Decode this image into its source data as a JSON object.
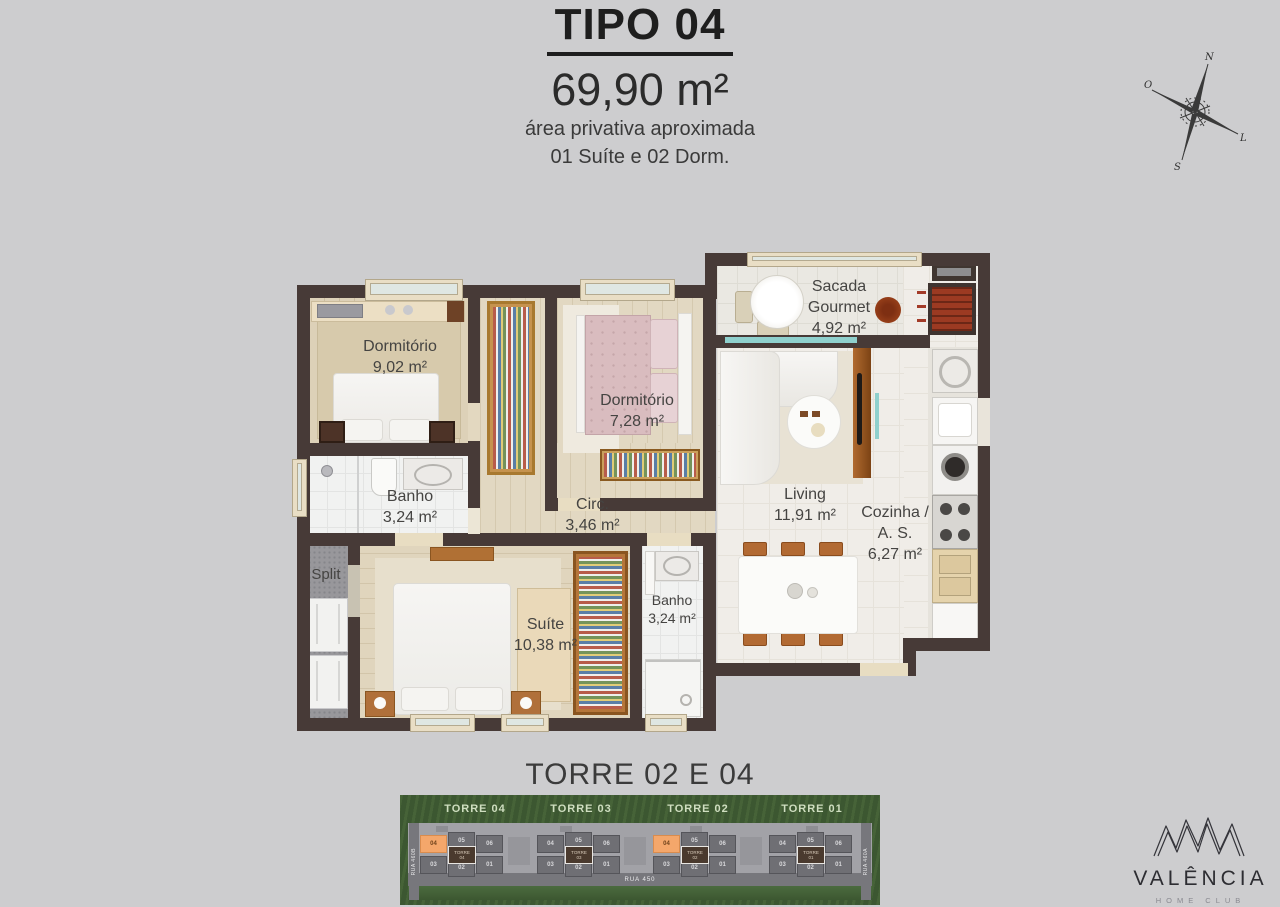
{
  "header": {
    "title": "TIPO 04",
    "area": "69,90 m²",
    "line1": "área privativa aproximada",
    "line2": "01 Suíte e 02 Dorm."
  },
  "compass": {
    "n": "N",
    "o": "O",
    "l": "L",
    "s": "S"
  },
  "plan": {
    "dorm1": {
      "name": "Dormitório",
      "area": "9,02 m²"
    },
    "dorm2": {
      "name": "Dormitório",
      "area": "7,28 m²"
    },
    "sacada": {
      "l1": "Sacada",
      "l2": "Gourmet",
      "area": "4,92 m²"
    },
    "banho1": {
      "name": "Banho",
      "area": "3,24 m²"
    },
    "circ": {
      "name": "Circ.",
      "area": "3,46 m²"
    },
    "living": {
      "name": "Living",
      "area": "11,91 m²"
    },
    "cozinha": {
      "l1": "Cozinha /",
      "l2": "A. S.",
      "area": "6,27 m²"
    },
    "split": {
      "name": "Split"
    },
    "suite": {
      "name": "Suíte",
      "area": "10,38 m²"
    },
    "banho2": {
      "name": "Banho",
      "area": "3,24 m²"
    }
  },
  "towers": {
    "heading": "TORRE 02 E 04",
    "labels": [
      "TORRE 04",
      "TORRE 03",
      "TORRE 02",
      "TORRE 01"
    ],
    "cores": [
      [
        "TORRE",
        "04"
      ],
      [
        "TORRE",
        "03"
      ],
      [
        "TORRE",
        "02"
      ],
      [
        "TORRE",
        "01"
      ]
    ],
    "units_top": [
      "04",
      "05",
      "06"
    ],
    "units_bottom": [
      "03",
      "02",
      "01"
    ],
    "highlight_color": "#f4a76b",
    "streets": {
      "bottom": "RUA 450",
      "left": "RUA 460B",
      "right": "RUA 460A"
    }
  },
  "logo": {
    "name": "VALÊNCIA",
    "tagline": "HOME CLUB"
  }
}
